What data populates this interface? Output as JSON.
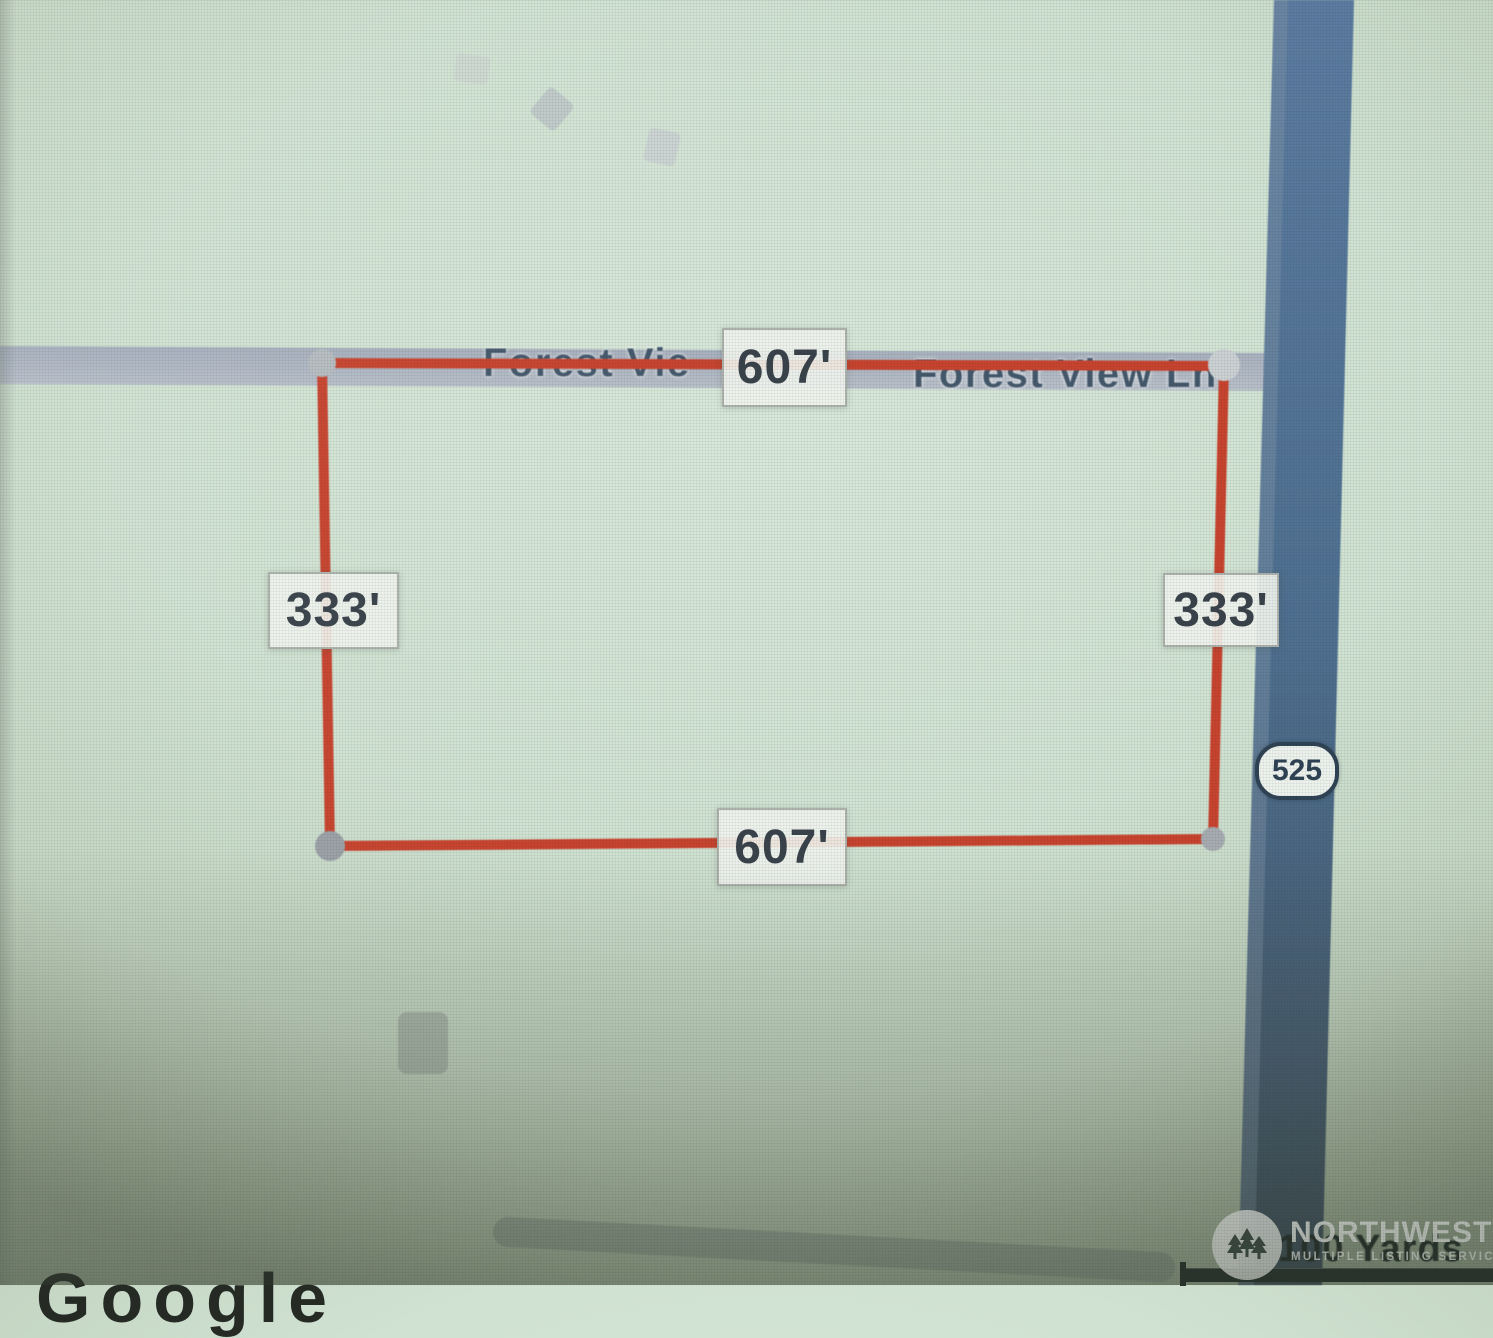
{
  "parcel": {
    "top_label": "607'",
    "bottom_label": "607'",
    "left_label": "333'",
    "right_label": "333'"
  },
  "roads": {
    "name_left": "Forest Vie",
    "name_right": "Forest View Ln",
    "highway_badge": "525"
  },
  "scale": {
    "label": "100 Yards"
  },
  "attribution": {
    "text": "Google"
  },
  "watermark": {
    "title": "NORTHWEST",
    "subtitle": "MULTIPLE LISTING SERVICE",
    "logo_icon": "evergreen-trees-icon"
  },
  "colors": {
    "map_background": "#cfe1d1",
    "parcel_line": "#c8432e",
    "highway_fill": "#4e6f90",
    "road_fill": "#afb8c3",
    "dimension_text": "#39424a",
    "road_label_text": "#44586c",
    "badge_text": "#2f4254",
    "scale_bar": "#26302d"
  }
}
